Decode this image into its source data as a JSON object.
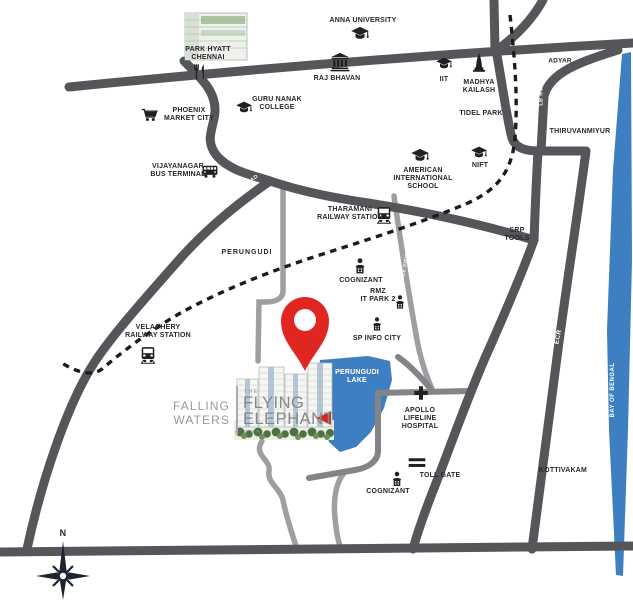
{
  "map": {
    "colors": {
      "road_major": "#55565a",
      "road_minor": "#9d9fa2",
      "road_medium": "#828487",
      "railway": "#1e1b20",
      "water": "#3e7fc1",
      "pin_red": "#e02620",
      "label_text": "#2a262c",
      "road_label_text": "#ffffff",
      "logo_gray": "#8e9194"
    },
    "landmarks": [
      {
        "id": "anna-university",
        "icon": "graduation-cap-icon",
        "icon_x": 360,
        "icon_y": 34,
        "icon_size": 19,
        "text": "ANNA UNIVERSITY",
        "x": 363,
        "y": 21
      },
      {
        "id": "park-hyatt-chennai",
        "icon": "restaurant-icon",
        "icon_x": 200,
        "icon_y": 72,
        "icon_size": 17,
        "text": "PARK HYATT\nCHENNAI",
        "x": 208,
        "y": 54
      },
      {
        "id": "raj-bhavan",
        "icon": "bank-icon",
        "icon_x": 340,
        "icon_y": 62,
        "icon_size": 21,
        "text": "RAJ BHAVAN",
        "x": 337,
        "y": 79
      },
      {
        "id": "iit",
        "icon": "graduation-cap-icon",
        "icon_x": 444,
        "icon_y": 64,
        "icon_size": 17,
        "text": "IIT",
        "x": 444,
        "y": 80
      },
      {
        "id": "madhya-kailash",
        "icon": "temple-icon",
        "icon_x": 479,
        "icon_y": 63,
        "icon_size": 21,
        "text": "MADHYA\nKAILASH",
        "x": 479,
        "y": 87
      },
      {
        "id": "adyar",
        "text": "ADYAR",
        "x": 560,
        "y": 61,
        "size": 6.5
      },
      {
        "id": "tidel-park",
        "text": "TIDEL PARK",
        "x": 481,
        "y": 114
      },
      {
        "id": "thiruvanmiyur",
        "text": "THIRUVANMIYUR",
        "x": 580,
        "y": 132
      },
      {
        "id": "guru-nanak-college",
        "icon": "graduation-cap-icon",
        "icon_x": 244,
        "icon_y": 108,
        "icon_size": 17,
        "text": "GURU NANAK\nCOLLEGE",
        "x": 277,
        "y": 104
      },
      {
        "id": "phoenix-market-city",
        "icon": "shopping-cart-icon",
        "icon_x": 150,
        "icon_y": 116,
        "icon_size": 18,
        "text": "PHOENIX\nMARKET CITY",
        "x": 189,
        "y": 115
      },
      {
        "id": "vijayanagar-bus-terminal",
        "icon": "bus-icon",
        "icon_x": 210,
        "icon_y": 171,
        "icon_size": 17,
        "text": "VIJAYANAGAR\nBUS TERMINAL",
        "x": 178,
        "y": 171
      },
      {
        "id": "american-international-school",
        "icon": "graduation-cap-icon",
        "icon_x": 420,
        "icon_y": 156,
        "icon_size": 19,
        "text": "AMERICAN\nINTERNATIONAL\nSCHOOL",
        "x": 423,
        "y": 179
      },
      {
        "id": "nift",
        "icon": "graduation-cap-icon",
        "icon_x": 479,
        "icon_y": 153,
        "icon_size": 17,
        "text": "NIFT",
        "x": 480,
        "y": 166
      },
      {
        "id": "tharamani-railway-station",
        "icon": "train-icon",
        "icon_x": 384,
        "icon_y": 215,
        "icon_size": 18,
        "text": "THARAMANI\nRAILWAY STATION",
        "x": 350,
        "y": 214
      },
      {
        "id": "srp-tools",
        "text": "SRP\nTOOLS",
        "x": 517,
        "y": 235
      },
      {
        "id": "perungudi",
        "text": "PERUNGUDI",
        "x": 247,
        "y": 253,
        "ls": 1
      },
      {
        "id": "cognizant-north",
        "icon": "office-icon",
        "icon_x": 360,
        "icon_y": 266,
        "icon_size": 17,
        "text": "COGNIZANT",
        "x": 361,
        "y": 281
      },
      {
        "id": "rmz-it-park-2",
        "icon": "office-icon",
        "icon_x": 400,
        "icon_y": 302,
        "icon_size": 15,
        "text": "RMZ\nIT PARK 2",
        "x": 378,
        "y": 296
      },
      {
        "id": "sp-info-city",
        "icon": "office-icon",
        "icon_x": 377,
        "icon_y": 324,
        "icon_size": 15,
        "text": "SP INFO CITY",
        "x": 377,
        "y": 339
      },
      {
        "id": "velachery-railway-station",
        "icon": "train-icon",
        "icon_x": 148,
        "icon_y": 355,
        "icon_size": 18,
        "text": "VELACHERY\nRAILWAY STATION",
        "x": 158,
        "y": 332
      },
      {
        "id": "perungudi-lake",
        "text": "PERUNGUDI\nLAKE",
        "x": 357,
        "y": 377,
        "color": "#ffffff"
      },
      {
        "id": "apollo-lifeline-hospital",
        "icon": "hospital-cross-icon",
        "icon_x": 421,
        "icon_y": 393,
        "icon_size": 17,
        "text": "APOLLO\nLIFELINE\nHOSPITAL",
        "x": 420,
        "y": 419
      },
      {
        "id": "toll-gate",
        "icon": "toll-gate-icon",
        "icon_x": 417,
        "icon_y": 463,
        "icon_size": 19,
        "text": "TOLL GATE",
        "x": 440,
        "y": 476
      },
      {
        "id": "cognizant-south",
        "icon": "office-icon",
        "icon_x": 397,
        "icon_y": 479,
        "icon_size": 16,
        "text": "COGNIZANT",
        "x": 388,
        "y": 492
      },
      {
        "id": "kottivakam",
        "text": "KOTTIVAKAM",
        "x": 563,
        "y": 471
      },
      {
        "id": "compass-north",
        "text": "N",
        "x": 63,
        "y": 533,
        "size": 9
      }
    ],
    "road_labels": [
      {
        "id": "tharamani-main-road-label",
        "text": "THARAMANI MAIN ROAD",
        "x": 229,
        "y": 198,
        "rot": -36,
        "size": 5.3
      },
      {
        "id": "lb-road-label",
        "text": "LB ROAD",
        "x": 542,
        "y": 92,
        "rot": -90,
        "size": 5.3
      },
      {
        "id": "omr-label",
        "text": "OMR",
        "x": 464,
        "y": 336,
        "rot": -63,
        "size": 6.5
      },
      {
        "id": "ecr-label",
        "text": "ECR",
        "x": 559,
        "y": 337,
        "rot": -78,
        "size": 6.5
      },
      {
        "id": "lake-view-rd-label",
        "text": "LAKE VIEW RD",
        "x": 407,
        "y": 264,
        "rot": -80,
        "size": 4.8
      },
      {
        "id": "bay-of-bengal-label",
        "text": "BAY OF BENGAL",
        "x": 613,
        "y": 390,
        "rot": -90,
        "size": 6
      }
    ]
  },
  "logo": {
    "developer_line1": "FALLING",
    "developer_line2": "WATERS",
    "prefix": "THE",
    "name_line1": "FLYING",
    "name_line2": "ELEPHANT",
    "tagline": "OMR"
  }
}
